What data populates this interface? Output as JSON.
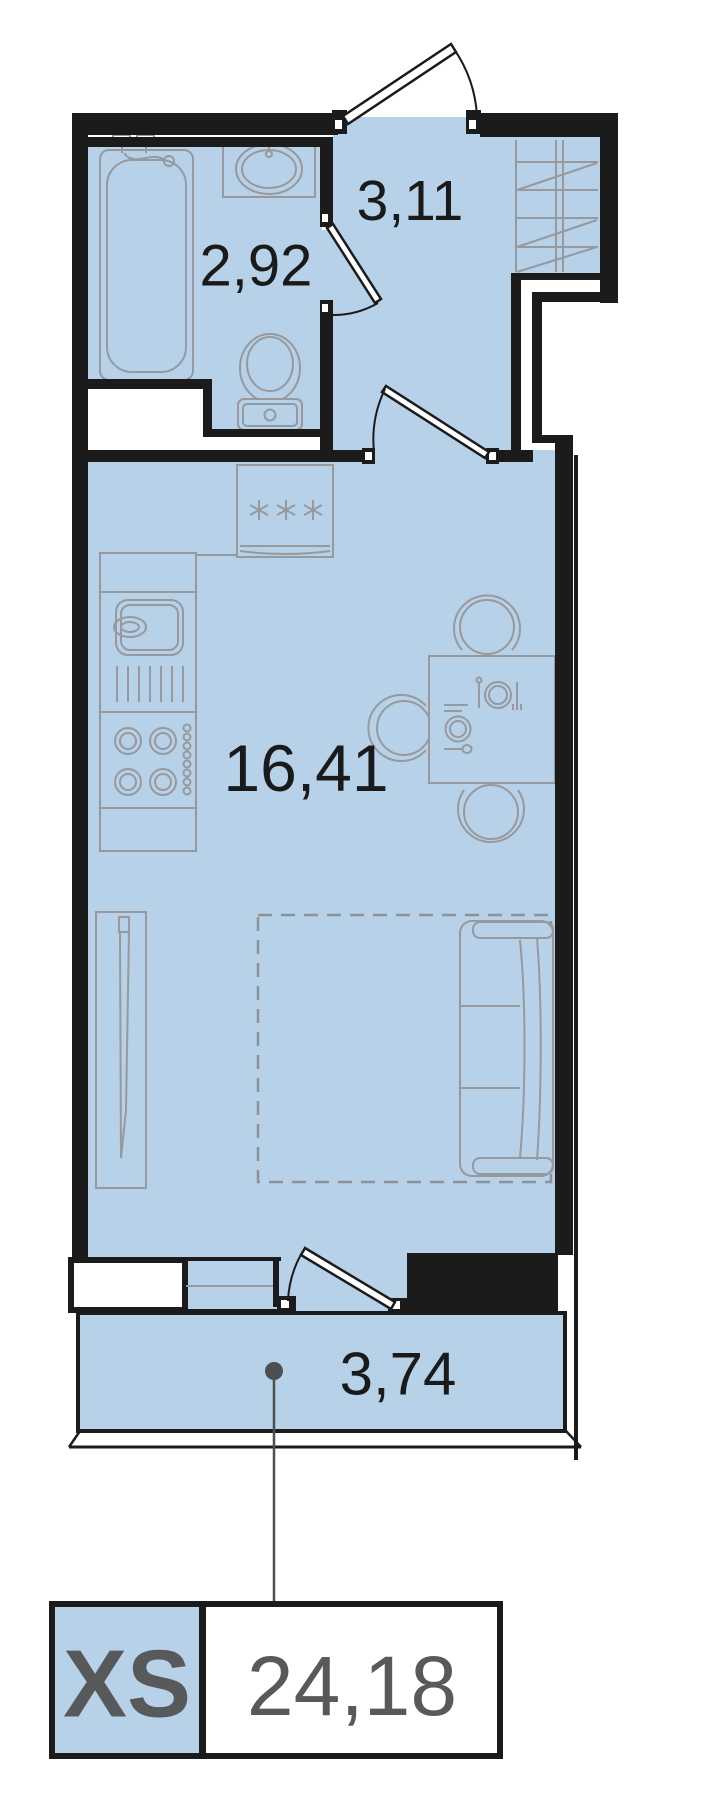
{
  "plan": {
    "badge": {
      "type_label": "XS",
      "total_area": "24,18"
    },
    "rooms": [
      {
        "name": "bathroom",
        "area": "2,92"
      },
      {
        "name": "hallway",
        "area": "3,11"
      },
      {
        "name": "living-kitchen",
        "area": "16,41"
      },
      {
        "name": "balcony",
        "area": "3,74"
      }
    ],
    "colors": {
      "room_fill": "#b6d1e8",
      "wall": "#1b1b1b",
      "furniture_line": "#97999c",
      "label_text": "#1a1a1a",
      "badge_text": "#58595b",
      "callout": "#4d4f50"
    }
  }
}
